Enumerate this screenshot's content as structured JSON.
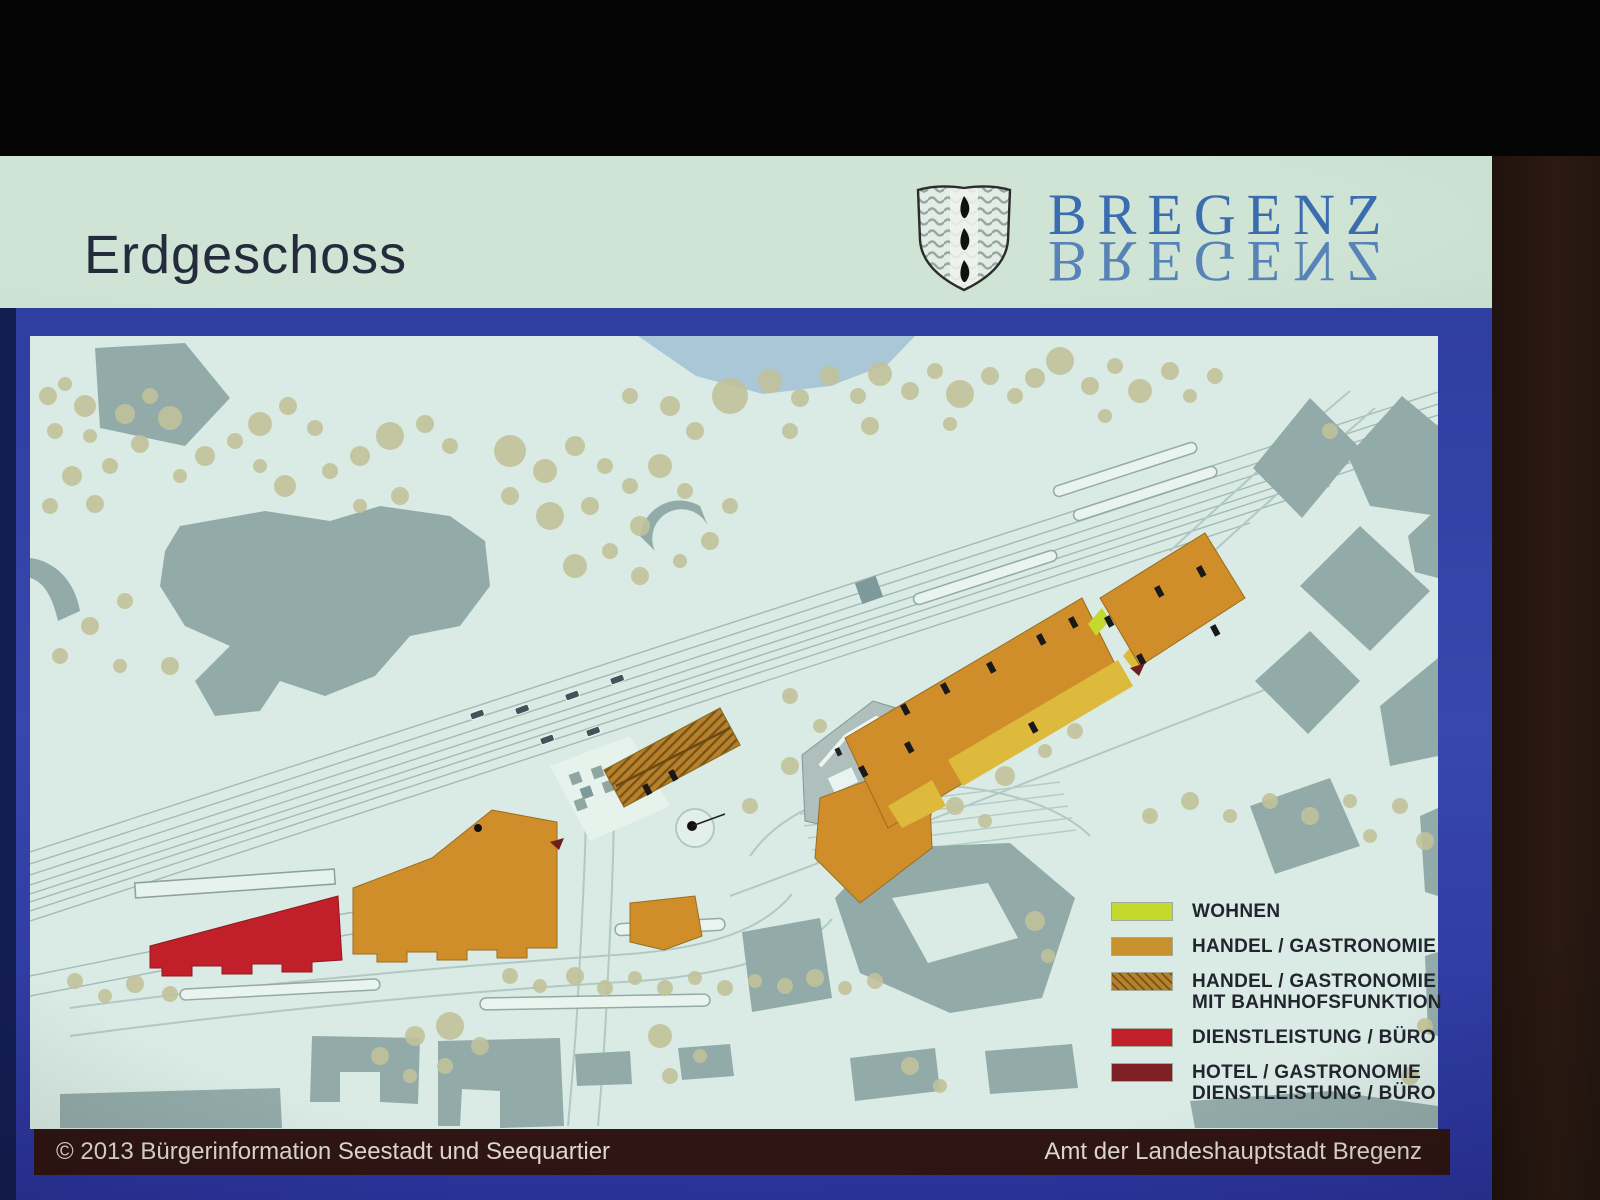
{
  "header": {
    "title": "Erdgeschoss",
    "logo_text": "BREGENZ"
  },
  "legend": {
    "items": [
      {
        "label_lines": [
          "WOHNEN"
        ],
        "color": "#c3d92e",
        "hatched": false,
        "hatch_color": null
      },
      {
        "label_lines": [
          "HANDEL / GASTRONOMIE"
        ],
        "color": "#c9902e",
        "hatched": false,
        "hatch_color": null
      },
      {
        "label_lines": [
          "HANDEL / GASTRONOMIE",
          "MIT BAHNHOFSFUNKTION"
        ],
        "color": "#b5812c",
        "hatched": true,
        "hatch_color": "#7a5216"
      },
      {
        "label_lines": [
          "DIENSTLEISTUNG / BÜRO"
        ],
        "color": "#c1202a",
        "hatched": false,
        "hatch_color": null
      },
      {
        "label_lines": [
          "HOTEL / GASTRONOMIE",
          "DIENSTLEISTUNG / BÜRO"
        ],
        "color": "#7c2024",
        "hatched": false,
        "hatch_color": null
      }
    ]
  },
  "footer": {
    "left": "© 2013 Bürgerinformation Seestadt und Seequartier",
    "right": "Amt der Landeshauptstadt Bregenz"
  },
  "colors": {
    "photo_background": "#050505",
    "wall_right_brown": "#2b1a12",
    "slide_border_blue": "#3241a0",
    "slide_border_dark_edge": "#141d52",
    "header_background": "#c6dbca",
    "title_text": "#242b3c",
    "logo_blue": "#3a6cb0",
    "map_background": "#d9ebe4",
    "lake_blue": "#a9c7d6",
    "existing_building_gray": "#92aba9",
    "tree_olive": "#c2c29a",
    "road_line": "#b2c8c2",
    "footer_bar": "#2f1514",
    "footer_text": "#ded9d0"
  }
}
